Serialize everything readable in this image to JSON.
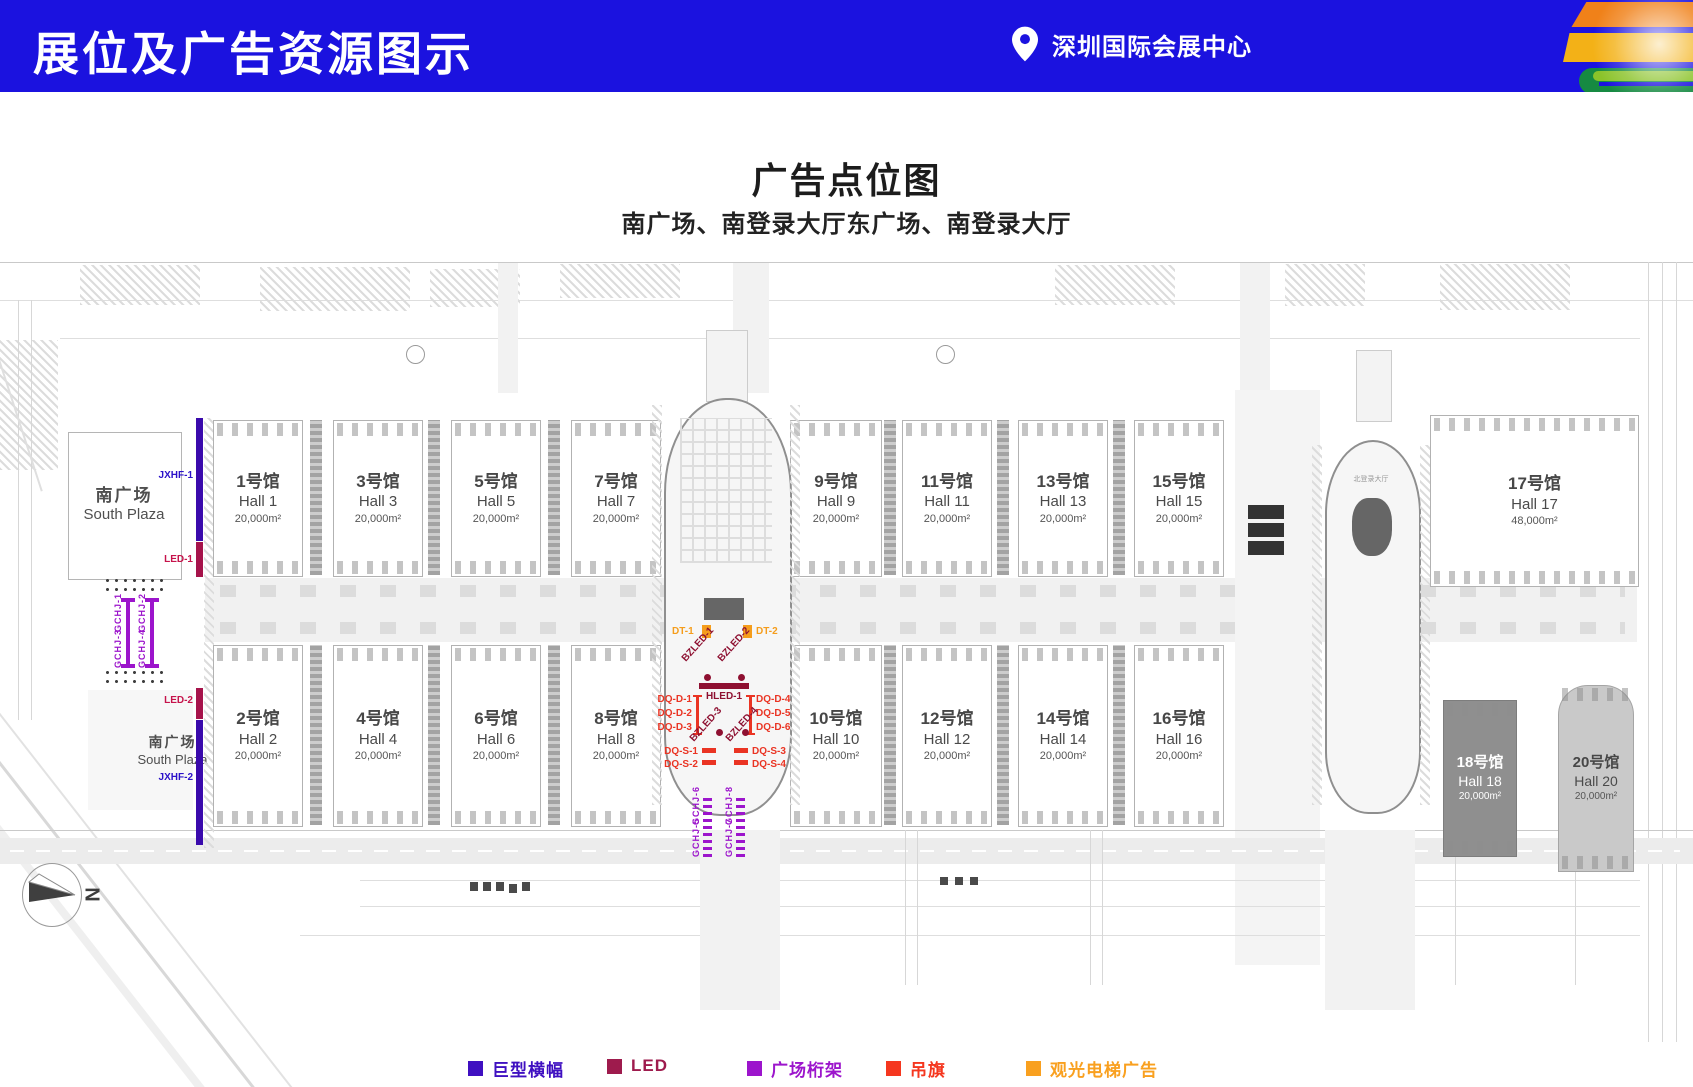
{
  "header": {
    "title": "展位及广告资源图示",
    "venue": "深圳国际会展中心"
  },
  "titles": {
    "main": "广告点位图",
    "sub": "南广场、南登录大厅东广场、南登录大厅"
  },
  "south_plaza": {
    "cn": "南广场",
    "en": "South Plaza"
  },
  "north_lobby": {
    "cn": "北登录大厅"
  },
  "halls": {
    "h1": {
      "cn": "1号馆",
      "en": "Hall 1",
      "area": "20,000m²"
    },
    "h2": {
      "cn": "2号馆",
      "en": "Hall 2",
      "area": "20,000m²"
    },
    "h3": {
      "cn": "3号馆",
      "en": "Hall 3",
      "area": "20,000m²"
    },
    "h4": {
      "cn": "4号馆",
      "en": "Hall 4",
      "area": "20,000m²"
    },
    "h5": {
      "cn": "5号馆",
      "en": "Hall 5",
      "area": "20,000m²"
    },
    "h6": {
      "cn": "6号馆",
      "en": "Hall 6",
      "area": "20,000m²"
    },
    "h7": {
      "cn": "7号馆",
      "en": "Hall 7",
      "area": "20,000m²"
    },
    "h8": {
      "cn": "8号馆",
      "en": "Hall 8",
      "area": "20,000m²"
    },
    "h9": {
      "cn": "9号馆",
      "en": "Hall 9",
      "area": "20,000m²"
    },
    "h10": {
      "cn": "10号馆",
      "en": "Hall 10",
      "area": "20,000m²"
    },
    "h11": {
      "cn": "11号馆",
      "en": "Hall 11",
      "area": "20,000m²"
    },
    "h12": {
      "cn": "12号馆",
      "en": "Hall 12",
      "area": "20,000m²"
    },
    "h13": {
      "cn": "13号馆",
      "en": "Hall 13",
      "area": "20,000m²"
    },
    "h14": {
      "cn": "14号馆",
      "en": "Hall 14",
      "area": "20,000m²"
    },
    "h15": {
      "cn": "15号馆",
      "en": "Hall 15",
      "area": "20,000m²"
    },
    "h16": {
      "cn": "16号馆",
      "en": "Hall 16",
      "area": "20,000m²"
    },
    "h17": {
      "cn": "17号馆",
      "en": "Hall 17",
      "area": "48,000m²"
    },
    "h18": {
      "cn": "18号馆",
      "en": "Hall 18",
      "area": "20,000m²"
    },
    "h20": {
      "cn": "20号馆",
      "en": "Hall 20",
      "area": "20,000m²"
    }
  },
  "markers": {
    "jxhf1": "JXHF-1",
    "jxhf2": "JXHF-2",
    "led1": "LED-1",
    "led2": "LED-2",
    "gchj1": "GCHJ-1",
    "gchj2": "GCHJ-2",
    "gchj3": "GCHJ-3",
    "gchj4": "GCHJ-4",
    "gchj5": "GCHJ-5",
    "gchj6": "GCHJ-6",
    "gchj7": "GCHJ-7",
    "gchj8": "GCHJ-8",
    "dt1": "DT-1",
    "dt2": "DT-2",
    "bzled1": "BZLED-1",
    "bzled2": "BZLED-2",
    "bzled3": "BZLED-3",
    "bzled4": "BZLED-4",
    "hled1": "HLED-1",
    "dqd1": "DQ-D-1",
    "dqd2": "DQ-D-2",
    "dqd3": "DQ-D-3",
    "dqd4": "DQ-D-4",
    "dqd5": "DQ-D-5",
    "dqd6": "DQ-D-6",
    "dqs1": "DQ-S-1",
    "dqs2": "DQ-S-2",
    "dqs3": "DQ-S-3",
    "dqs4": "DQ-S-4"
  },
  "compass": {
    "n": "N"
  },
  "legend": {
    "jxhf": {
      "label": "巨型横幅",
      "color": "#3f10c1"
    },
    "led": {
      "label": "LED",
      "color": "#9e1b4d"
    },
    "gchj": {
      "label": "广场桁架",
      "color": "#9c15cc"
    },
    "dq": {
      "label": "吊旗",
      "color": "#f5371f"
    },
    "dt": {
      "label": "观光电梯广告",
      "color": "#f9a01f"
    }
  }
}
